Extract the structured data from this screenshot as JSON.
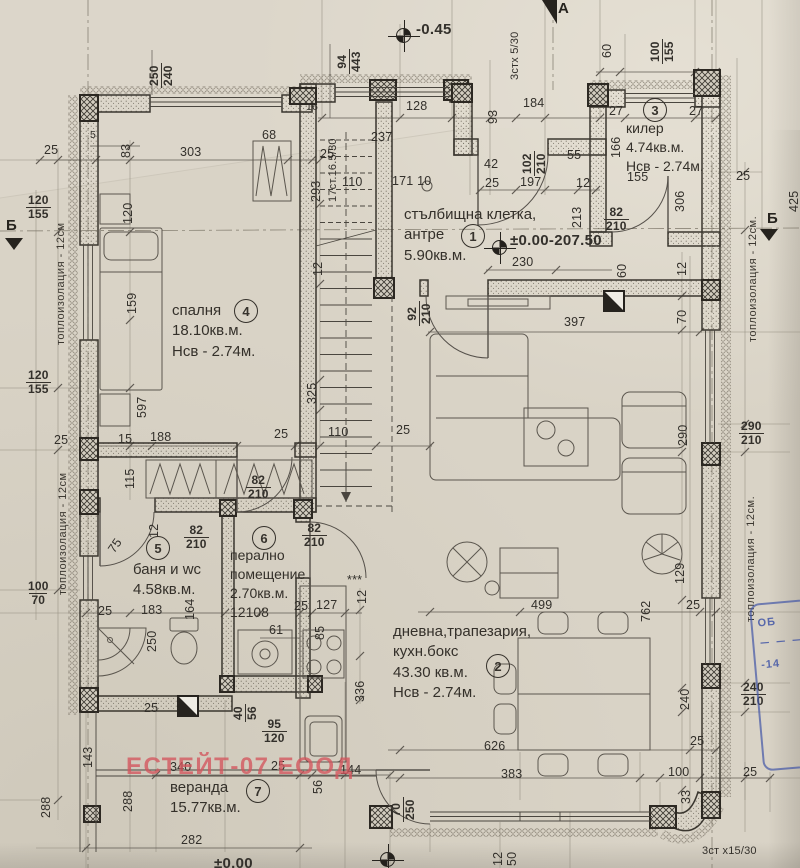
{
  "colors": {
    "paper": "#d9d3c6",
    "ink": "#37332d",
    "watermark": "#d4555c",
    "stamp": "#4256a6"
  },
  "watermark": {
    "text": "ЕСТЕЙТ-07 ЕООД"
  },
  "stamp": {
    "lines": [
      "ОБ",
      "－ － －",
      "-14"
    ]
  },
  "axis_markers": [
    {
      "label": "Б",
      "x": 6,
      "y": 217,
      "tx": 5,
      "ty": 238,
      "dir": "down"
    },
    {
      "label": "Б",
      "x": 767,
      "y": 210,
      "tx": 760,
      "ty": 229,
      "dir": "down"
    },
    {
      "label": "А",
      "x": 558,
      "y": 0,
      "tx": 542,
      "ty": 0,
      "dir": "flag"
    }
  ],
  "elevations": [
    {
      "text": "-0.45",
      "tx": 416,
      "ty": 22,
      "sx": 396,
      "sy": 28
    },
    {
      "text": "±0.00-207.50",
      "tx": 510,
      "ty": 233,
      "sx": 492,
      "sy": 240
    },
    {
      "text": "±0.00",
      "tx": 214,
      "ty": 856,
      "sx": 380,
      "sy": 852
    }
  ],
  "rooms": [
    {
      "num": "1",
      "x": 404,
      "y": 205,
      "nx": 461,
      "ny": 224,
      "lines": [
        "стълбищна клетка,",
        "антре",
        "5.90кв.м."
      ]
    },
    {
      "num": "2",
      "x": 393,
      "y": 622,
      "nx": 486,
      "ny": 654,
      "lines": [
        "дневна,трапезария,",
        "кухн.бокс",
        "43.30 кв.м.",
        "Нсв - 2.74м."
      ]
    },
    {
      "num": "3",
      "x": 626,
      "y": 119,
      "nx": 643,
      "ny": 98,
      "fs": 14,
      "lines": [
        "килер",
        "4.74кв.м.",
        "Нсв - 2.74м."
      ]
    },
    {
      "num": "4",
      "x": 172,
      "y": 301,
      "nx": 234,
      "ny": 299,
      "lines": [
        "спалня",
        "18.10кв.м.",
        "Нсв - 2.74м."
      ]
    },
    {
      "num": "5",
      "x": 133,
      "y": 560,
      "nx": 146,
      "ny": 536,
      "lines": [
        "баня и wc",
        "4.58кв.м."
      ]
    },
    {
      "num": "6",
      "x": 230,
      "y": 546,
      "nx": 252,
      "ny": 526,
      "fs": 14,
      "lines": [
        "перално",
        "помещение",
        "2.70кв.м.",
        "12108"
      ]
    },
    {
      "num": "7",
      "x": 170,
      "y": 778,
      "nx": 246,
      "ny": 779,
      "lines": [
        "веранда",
        "15.77кв.м."
      ]
    }
  ],
  "labels": [
    {
      "t": "94|443",
      "x": 336,
      "y": 74,
      "r": -90,
      "f": 1
    },
    {
      "t": "128",
      "x": 406,
      "y": 100
    },
    {
      "t": "93",
      "x": 487,
      "y": 124,
      "r": -90
    },
    {
      "t": "184",
      "x": 523,
      "y": 97
    },
    {
      "t": "16",
      "x": 306,
      "y": 102,
      "s": 1
    },
    {
      "t": "237",
      "x": 371,
      "y": 131
    },
    {
      "t": "100|155",
      "x": 649,
      "y": 64,
      "r": -90,
      "f": 1
    },
    {
      "t": "60",
      "x": 601,
      "y": 58,
      "r": -90
    },
    {
      "t": "27",
      "x": 609,
      "y": 105
    },
    {
      "t": "27",
      "x": 689,
      "y": 105
    },
    {
      "t": "166",
      "x": 610,
      "y": 158,
      "r": -90
    },
    {
      "t": "155",
      "x": 627,
      "y": 171
    },
    {
      "t": "25",
      "x": 736,
      "y": 170
    },
    {
      "t": "306",
      "x": 674,
      "y": 212,
      "r": -90
    },
    {
      "t": "425",
      "x": 788,
      "y": 212,
      "r": -90
    },
    {
      "t": "102|210",
      "x": 521,
      "y": 176,
      "r": -90,
      "f": 1
    },
    {
      "t": "55",
      "x": 567,
      "y": 149
    },
    {
      "t": "42",
      "x": 484,
      "y": 158
    },
    {
      "t": "25",
      "x": 485,
      "y": 177
    },
    {
      "t": "197",
      "x": 520,
      "y": 176
    },
    {
      "t": "12",
      "x": 576,
      "y": 177
    },
    {
      "t": "213",
      "x": 571,
      "y": 228,
      "r": -90
    },
    {
      "t": "82|210",
      "x": 604,
      "y": 206,
      "f": 1
    },
    {
      "t": "230",
      "x": 512,
      "y": 256
    },
    {
      "t": "60",
      "x": 616,
      "y": 278,
      "r": -90
    },
    {
      "t": "12",
      "x": 676,
      "y": 276,
      "r": -90
    },
    {
      "t": "70",
      "x": 676,
      "y": 324,
      "r": -90
    },
    {
      "t": "397",
      "x": 564,
      "y": 316
    },
    {
      "t": "290",
      "x": 677,
      "y": 446,
      "r": -90
    },
    {
      "t": "290|210",
      "x": 739,
      "y": 420,
      "f": 1
    },
    {
      "t": "129",
      "x": 674,
      "y": 584,
      "r": -90
    },
    {
      "t": "762",
      "x": 640,
      "y": 622,
      "r": -90
    },
    {
      "t": "25",
      "x": 686,
      "y": 599
    },
    {
      "t": "240",
      "x": 679,
      "y": 710,
      "r": -90
    },
    {
      "t": "240|210",
      "x": 741,
      "y": 681,
      "f": 1
    },
    {
      "t": "499",
      "x": 531,
      "y": 599
    },
    {
      "t": "626",
      "x": 484,
      "y": 740
    },
    {
      "t": "383",
      "x": 501,
      "y": 768
    },
    {
      "t": "25",
      "x": 690,
      "y": 735
    },
    {
      "t": "100",
      "x": 668,
      "y": 766
    },
    {
      "t": "25",
      "x": 743,
      "y": 766
    },
    {
      "t": "33",
      "x": 680,
      "y": 804,
      "r": -90
    },
    {
      "t": "12",
      "x": 492,
      "y": 866,
      "r": -90
    },
    {
      "t": "50",
      "x": 506,
      "y": 866,
      "r": -90
    },
    {
      "t": "70|250",
      "x": 390,
      "y": 822,
      "r": -90,
      "f": 1
    },
    {
      "t": "144",
      "x": 340,
      "y": 764
    },
    {
      "t": "56",
      "x": 312,
      "y": 794,
      "r": -90
    },
    {
      "t": "25",
      "x": 271,
      "y": 760
    },
    {
      "t": "340",
      "x": 170,
      "y": 761
    },
    {
      "t": "282",
      "x": 181,
      "y": 834
    },
    {
      "t": "288",
      "x": 40,
      "y": 818,
      "r": -90
    },
    {
      "t": "288",
      "x": 122,
      "y": 812,
      "r": -90
    },
    {
      "t": "143",
      "x": 82,
      "y": 768,
      "r": -90
    },
    {
      "t": "25",
      "x": 144,
      "y": 702
    },
    {
      "t": "250",
      "x": 146,
      "y": 652,
      "r": -90
    },
    {
      "t": "183",
      "x": 141,
      "y": 604
    },
    {
      "t": "25",
      "x": 98,
      "y": 605
    },
    {
      "t": "164",
      "x": 184,
      "y": 620,
      "r": -90
    },
    {
      "t": "95|120",
      "x": 262,
      "y": 718,
      "f": 1
    },
    {
      "t": "40|56",
      "x": 232,
      "y": 722,
      "r": -90,
      "f": 1
    },
    {
      "t": "61",
      "x": 269,
      "y": 624
    },
    {
      "t": "25",
      "x": 294,
      "y": 600
    },
    {
      "t": "127",
      "x": 316,
      "y": 599
    },
    {
      "t": "85",
      "x": 314,
      "y": 640,
      "r": -90
    },
    {
      "t": "12",
      "x": 356,
      "y": 604,
      "r": -90
    },
    {
      "t": "***",
      "x": 347,
      "y": 574
    },
    {
      "t": "336",
      "x": 354,
      "y": 702,
      "r": -90
    },
    {
      "t": "82|210",
      "x": 184,
      "y": 524,
      "f": 1
    },
    {
      "t": "82|210",
      "x": 302,
      "y": 522,
      "f": 1
    },
    {
      "t": "82|210",
      "x": 246,
      "y": 474,
      "f": 1
    },
    {
      "t": "75",
      "x": 106,
      "y": 548,
      "r": -55
    },
    {
      "t": "12",
      "x": 148,
      "y": 538,
      "r": -90
    },
    {
      "t": "25",
      "x": 54,
      "y": 434
    },
    {
      "t": "115",
      "x": 124,
      "y": 489,
      "r": -90
    },
    {
      "t": "15",
      "x": 118,
      "y": 433
    },
    {
      "t": "188",
      "x": 150,
      "y": 431
    },
    {
      "t": "25",
      "x": 274,
      "y": 428
    },
    {
      "t": "110",
      "x": 328,
      "y": 426
    },
    {
      "t": "25",
      "x": 396,
      "y": 424
    },
    {
      "t": "597",
      "x": 136,
      "y": 418,
      "r": -90
    },
    {
      "t": "120|155",
      "x": 26,
      "y": 194,
      "f": 1
    },
    {
      "t": "120|155",
      "x": 26,
      "y": 369,
      "f": 1
    },
    {
      "t": "100|70",
      "x": 28,
      "y": 580,
      "f": 1
    },
    {
      "t": "120",
      "x": 122,
      "y": 224,
      "r": -90
    },
    {
      "t": "159",
      "x": 126,
      "y": 314,
      "r": -90
    },
    {
      "t": "250|240",
      "x": 148,
      "y": 88,
      "r": -90,
      "f": 1
    },
    {
      "t": "25",
      "x": 44,
      "y": 144
    },
    {
      "t": "5",
      "x": 90,
      "y": 130,
      "s": 1
    },
    {
      "t": "83",
      "x": 120,
      "y": 158,
      "r": -90
    },
    {
      "t": "303",
      "x": 180,
      "y": 146
    },
    {
      "t": "68",
      "x": 262,
      "y": 129
    },
    {
      "t": "92|210",
      "x": 406,
      "y": 326,
      "r": -90,
      "f": 1
    },
    {
      "t": "325",
      "x": 306,
      "y": 404,
      "r": -90
    },
    {
      "t": "12",
      "x": 312,
      "y": 276,
      "r": -90
    },
    {
      "t": "293",
      "x": 310,
      "y": 202,
      "r": -90
    },
    {
      "t": "110",
      "x": 342,
      "y": 176
    },
    {
      "t": "171 10",
      "x": 392,
      "y": 175
    },
    {
      "t": "25",
      "x": 320,
      "y": 148
    },
    {
      "t": "3стх 5/30",
      "x": 510,
      "y": 80,
      "r": -90,
      "cls": "note"
    },
    {
      "t": "17ст.16.5/30",
      "x": 328,
      "y": 202,
      "r": -90,
      "cls": "note"
    },
    {
      "t": "3ст x15/30",
      "x": 702,
      "y": 846,
      "cls": "note"
    },
    {
      "t": "топлоизолация - 12см",
      "x": 56,
      "y": 345,
      "r": -90,
      "cls": "ins"
    },
    {
      "t": "топлоизолация - 12см",
      "x": 58,
      "y": 595,
      "r": -90,
      "cls": "ins"
    },
    {
      "t": "топлоизолация - 12см.",
      "x": 748,
      "y": 342,
      "r": -90,
      "cls": "ins"
    },
    {
      "t": "топлоизолация - 12см.",
      "x": 746,
      "y": 622,
      "r": -90,
      "cls": "ins"
    }
  ]
}
